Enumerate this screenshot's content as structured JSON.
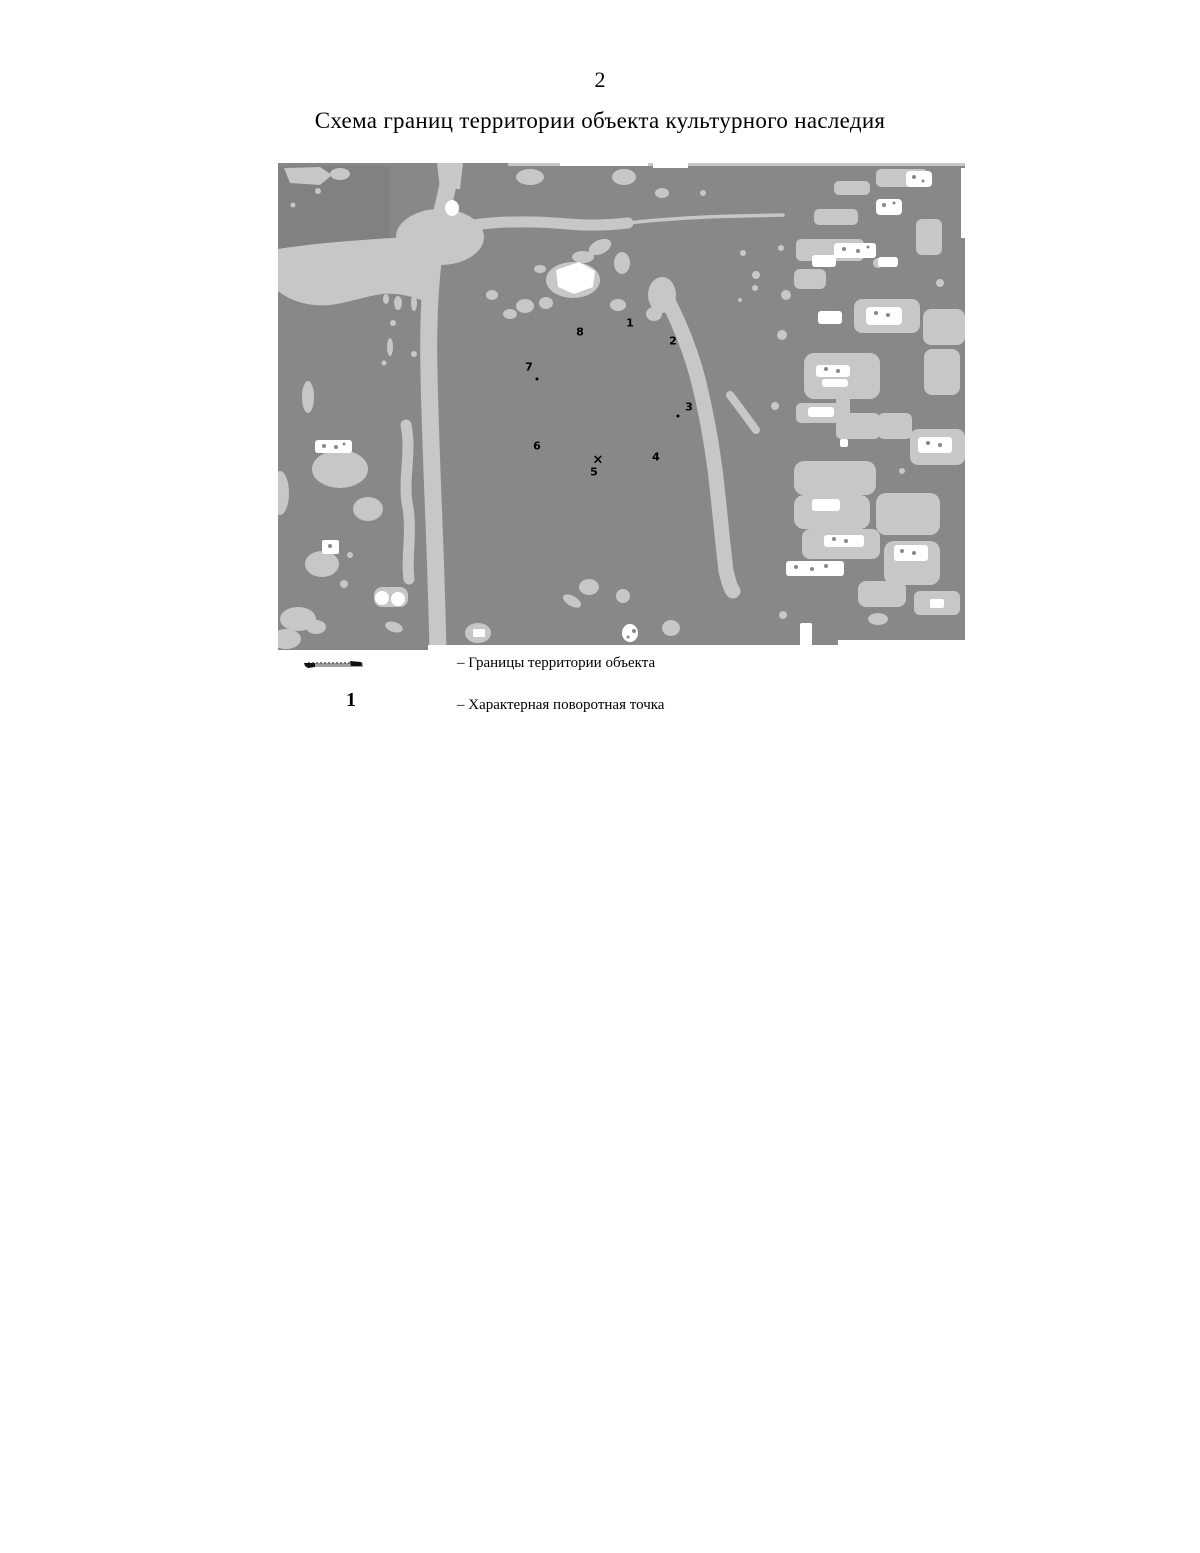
{
  "page": {
    "number": "2",
    "title": "Схема границ территории объекта культурного наследия"
  },
  "map": {
    "points": [
      {
        "label": "1",
        "x": 352,
        "y": 160
      },
      {
        "label": "2",
        "x": 395,
        "y": 178
      },
      {
        "label": "3",
        "x": 411,
        "y": 244
      },
      {
        "label": "4",
        "x": 378,
        "y": 294
      },
      {
        "label": "5",
        "x": 316,
        "y": 309
      },
      {
        "label": "6",
        "x": 259,
        "y": 283
      },
      {
        "label": "7",
        "x": 251,
        "y": 204
      },
      {
        "label": "8",
        "x": 302,
        "y": 169
      }
    ],
    "cross_mark": {
      "label": "×",
      "x": 320,
      "y": 297
    },
    "colors": {
      "map_base": "#888888",
      "map_light": "#c7c7c7",
      "map_white": "#ffffff",
      "marker": "#000000"
    }
  },
  "legend": {
    "items": [
      {
        "symbol": "boundary-line",
        "label": "– Границы территории объекта"
      },
      {
        "symbol": "1",
        "label": "– Характерная поворотная точка"
      }
    ]
  }
}
